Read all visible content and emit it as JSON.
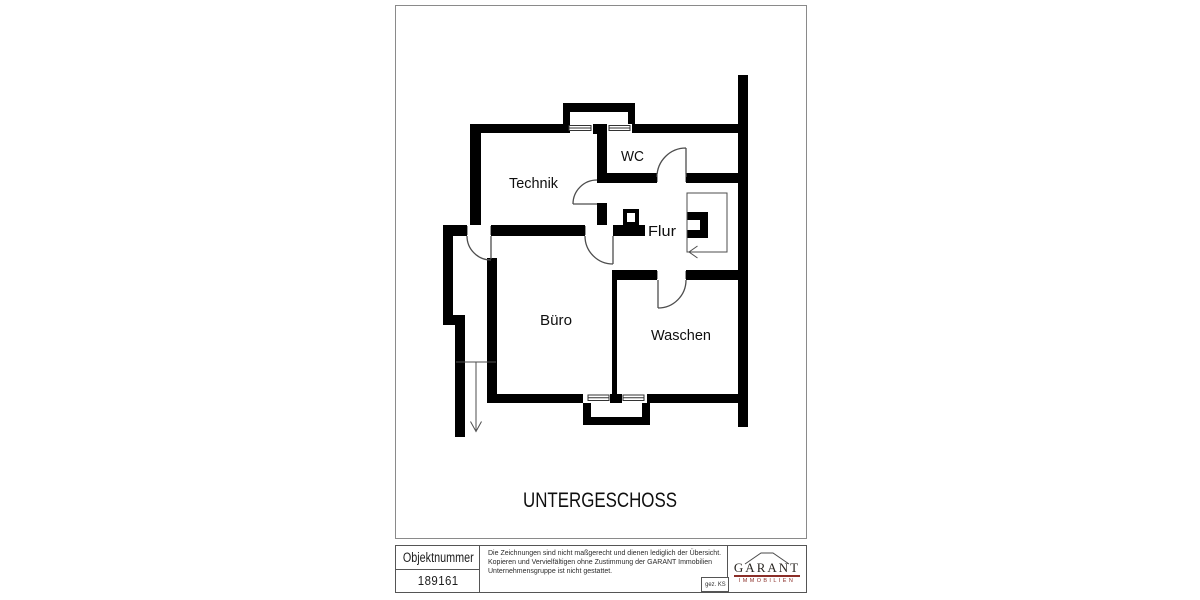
{
  "floor_plan": {
    "title": "UNTERGESCHOSS",
    "rooms": [
      {
        "label": "Technik"
      },
      {
        "label": "WC"
      },
      {
        "label": "Flur"
      },
      {
        "label": "Büro"
      },
      {
        "label": "Waschen"
      }
    ]
  },
  "title_block": {
    "object_number_label": "Objektnummer",
    "object_number_value": "189161",
    "disclaimer_line1": "Die Zeichnungen sind nicht maßgerecht und dienen lediglich der Übersicht.",
    "disclaimer_line2": "Kopieren und Vervielfältigen ohne Zustimmung der GARANT Immobilien",
    "disclaimer_line3": "Unternehmensgruppe ist nicht gestattet.",
    "signature": "gez. KS",
    "logo": {
      "brand": "GARANT",
      "subbrand": "IMMOBILIEN",
      "accent_color": "#8b2e28"
    }
  },
  "colors": {
    "walls": "#000000",
    "thin_lines": "#4d4d4d",
    "sheet_frame": "#8a8a8a",
    "table_border": "#555555"
  }
}
